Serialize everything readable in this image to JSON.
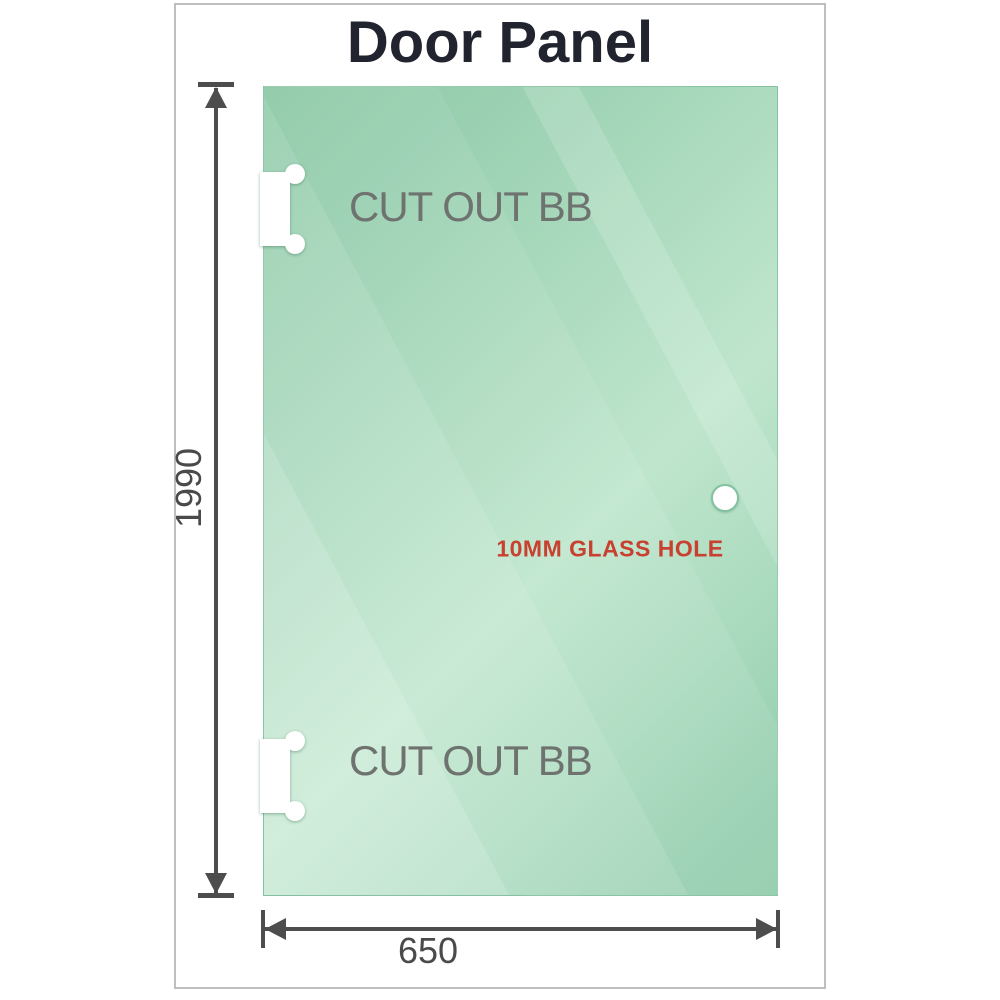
{
  "title": "Door Panel",
  "glass": {
    "cutout_labels": [
      "CUT OUT BB",
      "CUT OUT BB"
    ],
    "hole_label": "10MM GLASS HOLE"
  },
  "dimensions": {
    "height": "1990",
    "width": "650"
  },
  "colors": {
    "glass_base": "#8bc8a5",
    "glass_highlight": "#bfe6cd",
    "hole_label_red": "#c8402f",
    "cutout_label_gray": "#6f7370",
    "dimension_gray": "#4d4d4d",
    "frame_border": "#bcbfbe",
    "title_color": "#21242e"
  }
}
